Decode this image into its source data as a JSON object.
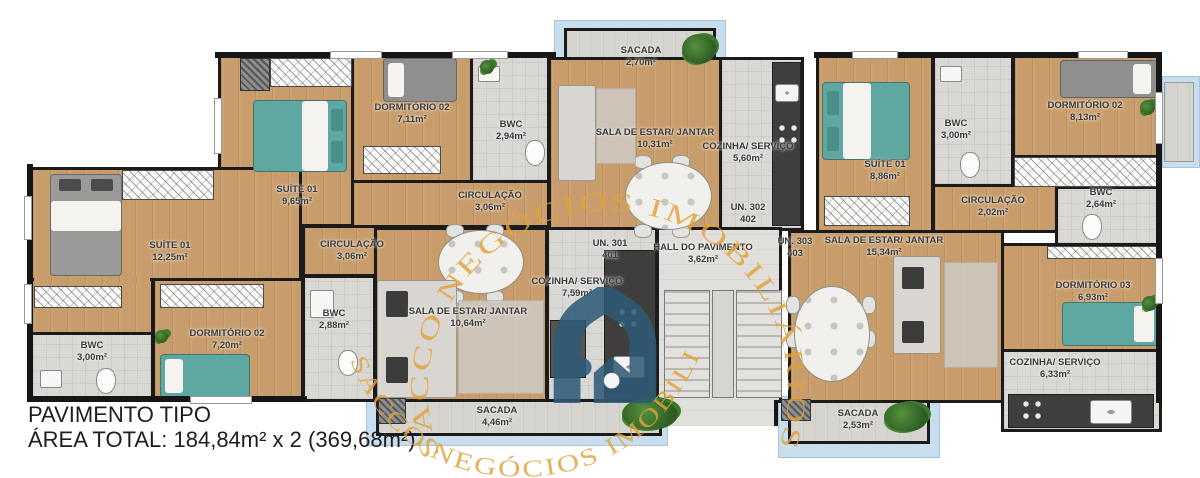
{
  "footer": {
    "line1": "PAVIMENTO TIPO",
    "line2": "ÁREA TOTAL: 184,84m² x 2 (369,68m²)"
  },
  "watermark": {
    "text": "SACCO NEGÓCIOS IMOBILIÁRIOS",
    "color": "#E2A23C"
  },
  "brand": {
    "logo": "house-arch-logo",
    "logo_color": "#2E5A78"
  },
  "hall": {
    "name": "HALL DO PAVIMENTO",
    "area": "3,62m²"
  },
  "units": {
    "u301": {
      "line1": "UN. 301",
      "line2": "401"
    },
    "u302": {
      "line1": "UN. 302",
      "line2": "402"
    },
    "u303": {
      "line1": "UN. 303",
      "line2": "403"
    }
  },
  "rooms": {
    "u301_suite": {
      "name": "SUÍTE 01",
      "area": "12,25m²"
    },
    "u301_bwc": {
      "name": "BWC",
      "area": "3,00m²"
    },
    "u301_dorm02": {
      "name": "DORMITÓRIO 02",
      "area": "7,20m²"
    },
    "u301_circ": {
      "name": "CIRCULAÇÃO",
      "area": "3,06m²"
    },
    "u301_bwc2": {
      "name": "BWC",
      "area": "2,88m²"
    },
    "u301_sala": {
      "name": "SALA DE ESTAR/ JANTAR",
      "area": "10,64m²"
    },
    "u301_cozinha": {
      "name": "COZINHA/ SERVIÇO",
      "area": "7,59m²"
    },
    "u301_sacada": {
      "name": "SACADA",
      "area": "4,46m²"
    },
    "u302_suite": {
      "name": "SUÍTE 01",
      "area": "9,65m²"
    },
    "u302_dorm02": {
      "name": "DORMITÓRIO 02",
      "area": "7,11m²"
    },
    "u302_bwc": {
      "name": "BWC",
      "area": "2,94m²"
    },
    "u302_circ": {
      "name": "CIRCULAÇÃO",
      "area": "3,06m²"
    },
    "u302_sala": {
      "name": "SALA DE ESTAR/ JANTAR",
      "area": "10,31m²"
    },
    "u302_cozinha": {
      "name": "COZINHA/ SERVIÇO",
      "area": "5,60m²"
    },
    "u302_sacada": {
      "name": "SACADA",
      "area": "2,70m²"
    },
    "u303_suite": {
      "name": "SUÍTE 01",
      "area": "8,86m²"
    },
    "u303_bwc": {
      "name": "BWC",
      "area": "3,00m²"
    },
    "u303_dorm02": {
      "name": "DORMITÓRIO 02",
      "area": "8,13m²"
    },
    "u303_circ": {
      "name": "CIRCULAÇÃO",
      "area": "2,02m²"
    },
    "u303_bwc2": {
      "name": "BWC",
      "area": "2,64m²"
    },
    "u303_sala": {
      "name": "SALA DE ESTAR/ JANTAR",
      "area": "15,34m²"
    },
    "u303_dorm03": {
      "name": "DORMITÓRIO 03",
      "area": "6,93m²"
    },
    "u303_cozinha": {
      "name": "COZINHA/ SERVIÇO",
      "area": "6,33m²"
    },
    "u303_sacada": {
      "name": "SACADA",
      "area": "2,53m²"
    }
  }
}
